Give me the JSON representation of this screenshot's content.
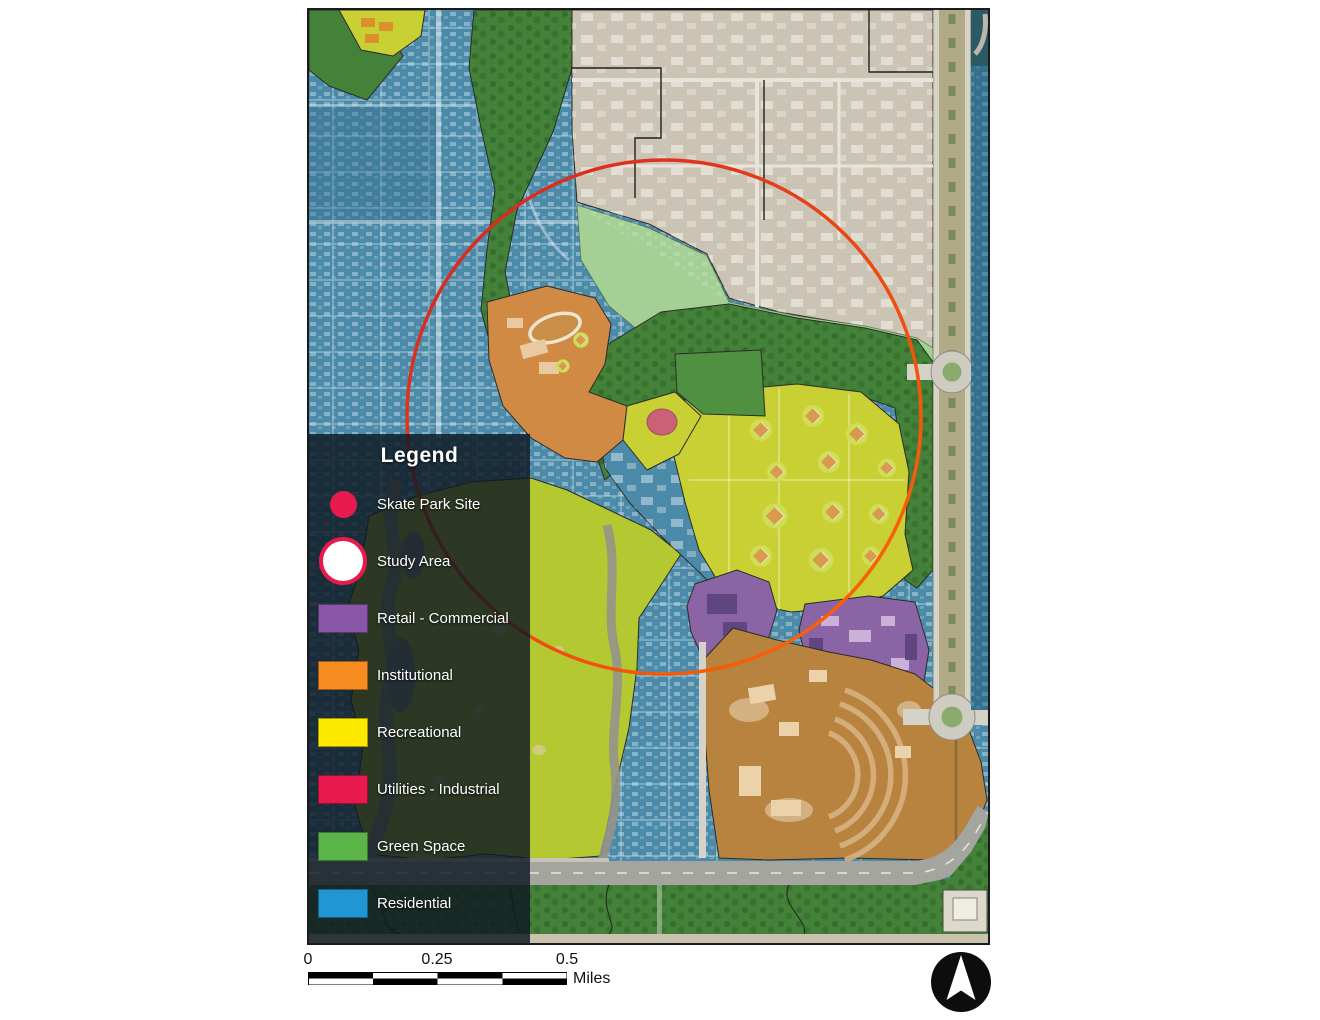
{
  "legend": {
    "title": "Legend",
    "panel_color": "rgba(13,23,33,0.82)",
    "items": [
      {
        "label": "Skate Park Site",
        "swatch": "circle",
        "color": "#e81a4d"
      },
      {
        "label": "Study Area",
        "swatch": "ring",
        "color": "#e81a4d",
        "fill": "#ffffff"
      },
      {
        "label": "Retail - Commercial",
        "swatch": "rect",
        "color": "#8a57a8"
      },
      {
        "label": "Institutional",
        "swatch": "rect",
        "color": "#f68b1f"
      },
      {
        "label": "Recreational",
        "swatch": "rect",
        "color": "#fde900"
      },
      {
        "label": "Utilities - Industrial",
        "swatch": "rect",
        "color": "#e81a4d"
      },
      {
        "label": "Green Space",
        "swatch": "rect",
        "color": "#5cb548"
      },
      {
        "label": "Residential",
        "swatch": "rect",
        "color": "#2196d3"
      }
    ]
  },
  "scalebar": {
    "ticks": [
      "0",
      "0.25",
      "0.5"
    ],
    "unit": "Miles"
  },
  "map_colors": {
    "residential": "#4c8aa9",
    "residential_dark": "#34708f",
    "green_dark": "#44823a",
    "green_mid": "#4f9140",
    "green_light": "#a4d096",
    "dev_gray": "#cbc4b4",
    "dev_light": "#ddd8cc",
    "boulevard": "#b2aa87",
    "road": "#d5d2c7",
    "highway": "#a5a5a0",
    "golf": "#b4c832",
    "fields_yellow": "#c9d034",
    "school_orange": "#d08a44",
    "campus_brown": "#b8823f",
    "purple": "#8b64a5",
    "wetland": "#939389",
    "skate_pink": "#c9557f",
    "teal_dark": "#2a5a66",
    "study_red": "#d42027",
    "study_orange": "#ff6b00"
  }
}
